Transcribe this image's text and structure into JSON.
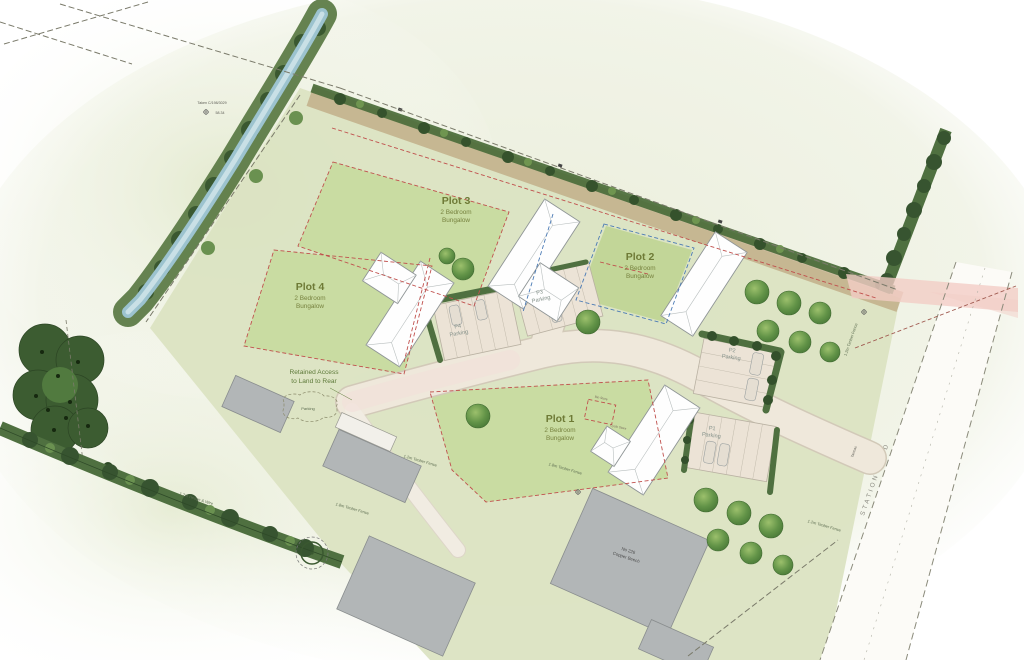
{
  "plots": [
    {
      "name": "Plot 1",
      "line1": "2 Bedroom",
      "line2": "Bungalow"
    },
    {
      "name": "Plot 2",
      "line1": "2 Bedroom",
      "line2": "Bungalow"
    },
    {
      "name": "Plot 3",
      "line1": "2 Bedroom",
      "line2": "Bungalow"
    },
    {
      "name": "Plot 4",
      "line1": "2 Bedroom",
      "line2": "Bungalow"
    }
  ],
  "parking": [
    {
      "id": "P1",
      "label": "Parking"
    },
    {
      "id": "P2",
      "label": "Parking"
    },
    {
      "id": "P3",
      "label": "Parking"
    },
    {
      "id": "P4",
      "label": "Parking"
    }
  ],
  "annotations": {
    "retained_access_line1": "Retained Access",
    "retained_access_line2": "to Land to Rear",
    "parking_cloud": "Parking",
    "survey_ref": "Taken C/198/3029",
    "survey_level": "58.34",
    "station_road": "STATION ROAD",
    "tarmac": "Tarmac",
    "existing_house_line1": "No 226",
    "existing_house_line2": "Copper Beech",
    "fence_18": "1.8m Timber Fence",
    "fence_12": "1.2m Timber Fence",
    "hedge_wire": "1.2m Hedge & Wire",
    "bin_store": "Bin Store",
    "cycle_store": "Cycle Store"
  },
  "colors": {
    "site_green": "#dbe3c2",
    "garden_green": "#c9dca2",
    "road_beige": "#efe8db",
    "building_white": "#fefefe",
    "existing_grey": "#b2b6b7",
    "tree_green": "#639448",
    "hedge_dark": "#4f7040",
    "stream_blue": "#9cc3cf",
    "removed_hedge_tan": "#b08a5f",
    "pink_highlight": "#f2cdc6",
    "boundary_red": "#c0504d",
    "boundary_blue": "#4a7ab5",
    "label_olive": "#6e7a36"
  }
}
